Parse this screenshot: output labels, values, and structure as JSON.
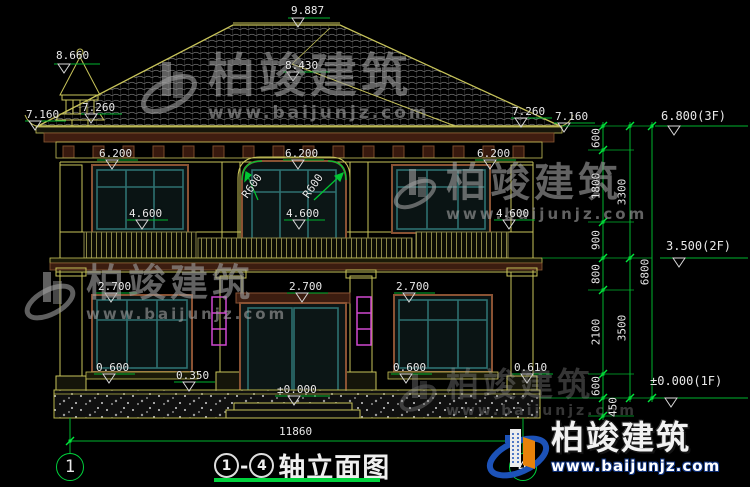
{
  "drawing": {
    "title": {
      "start_axis": "1",
      "separator": "-",
      "end_axis": "4",
      "name": "轴立面图"
    },
    "axis_bubbles": {
      "left": "1",
      "right": "4"
    }
  },
  "brand": {
    "name": "柏竣建筑",
    "url": "www.baijunjz.com"
  },
  "colors": {
    "background": "#000000",
    "line_yellow": "#c8c45a",
    "trim_brown": "#8a5233",
    "window_teal": "#2e7070",
    "dim_green": "#00c832",
    "lamp_magenta": "#d048d0",
    "logo_blue": "#1c52b8",
    "logo_orange": "#e8820a",
    "text_white": "#e9e9e9"
  },
  "labels": [
    {
      "t": "9.887",
      "x": 291,
      "y": 5
    },
    {
      "t": "8.660",
      "x": 56,
      "y": 50
    },
    {
      "t": "8.430",
      "x": 285,
      "y": 60
    },
    {
      "t": "7.160",
      "x": 26,
      "y": 109
    },
    {
      "t": "7.260",
      "x": 82,
      "y": 102
    },
    {
      "t": "7.260",
      "x": 512,
      "y": 106
    },
    {
      "t": "7.160",
      "x": 555,
      "y": 111
    },
    {
      "t": "6.800(3F)",
      "x": 661,
      "y": 110,
      "fs": 12
    },
    {
      "t": "3.500(2F)",
      "x": 666,
      "y": 240,
      "fs": 12
    },
    {
      "t": "±0.000(1F)",
      "x": 650,
      "y": 375,
      "fs": 12
    },
    {
      "t": "6.200",
      "x": 99,
      "y": 148
    },
    {
      "t": "6.200",
      "x": 285,
      "y": 148
    },
    {
      "t": "6.200",
      "x": 477,
      "y": 148
    },
    {
      "t": "4.600",
      "x": 129,
      "y": 208
    },
    {
      "t": "4.600",
      "x": 286,
      "y": 208
    },
    {
      "t": "4.600",
      "x": 496,
      "y": 208
    },
    {
      "t": "R600",
      "x": 252,
      "y": 186,
      "rot": -55
    },
    {
      "t": "R600",
      "x": 313,
      "y": 186,
      "rot": -55
    },
    {
      "t": "2.700",
      "x": 98,
      "y": 281
    },
    {
      "t": "2.700",
      "x": 289,
      "y": 281
    },
    {
      "t": "2.700",
      "x": 396,
      "y": 281
    },
    {
      "t": "0.600",
      "x": 96,
      "y": 362
    },
    {
      "t": "0.350",
      "x": 176,
      "y": 370
    },
    {
      "t": "0.600",
      "x": 393,
      "y": 362
    },
    {
      "t": "0.610",
      "x": 514,
      "y": 362
    },
    {
      "t": "±0.000",
      "x": 277,
      "y": 384
    },
    {
      "t": "11860",
      "x": 279,
      "y": 426
    },
    {
      "t": "600",
      "x": 596,
      "y": 138,
      "rot": -90
    },
    {
      "t": "1800",
      "x": 596,
      "y": 186,
      "rot": -90
    },
    {
      "t": "900",
      "x": 596,
      "y": 240,
      "rot": -90
    },
    {
      "t": "800",
      "x": 596,
      "y": 274,
      "rot": -90
    },
    {
      "t": "2100",
      "x": 596,
      "y": 332,
      "rot": -90
    },
    {
      "t": "600",
      "x": 596,
      "y": 386,
      "rot": -90
    },
    {
      "t": "450",
      "x": 613,
      "y": 407,
      "rot": -90
    },
    {
      "t": "3300",
      "x": 622,
      "y": 192,
      "rot": -90
    },
    {
      "t": "3500",
      "x": 622,
      "y": 328,
      "rot": -90
    },
    {
      "t": "6800",
      "x": 645,
      "y": 272,
      "rot": -90
    }
  ]
}
